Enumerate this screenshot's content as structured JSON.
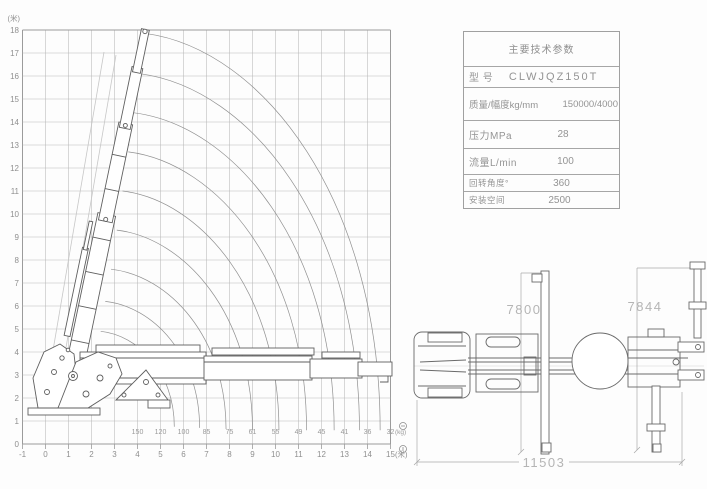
{
  "chart": {
    "y_unit": "(米)",
    "x_unit": "(米)",
    "load_unit": "(kg)",
    "y_ticks": [
      18,
      17,
      16,
      15,
      14,
      13,
      12,
      11,
      10,
      9,
      8,
      7,
      6,
      5,
      4,
      3,
      2,
      1,
      0
    ],
    "x_ticks": [
      -1,
      0,
      1,
      2,
      3,
      4,
      5,
      6,
      7,
      8,
      9,
      10,
      11,
      12,
      13,
      14,
      15
    ]
  },
  "chart_data": {
    "type": "line",
    "title": "起重机工作幅度载荷曲线图 (crane load-radius working range chart)",
    "xlabel": "(米)",
    "ylabel": "(米)",
    "xlim": [
      -1,
      15
    ],
    "ylim": [
      0,
      18
    ],
    "grid": true,
    "load_row": {
      "radius_m": [
        4,
        5,
        6,
        7,
        8,
        9,
        10,
        11,
        12,
        13,
        14,
        15
      ],
      "load_values": [
        150,
        120,
        100,
        85,
        75,
        61,
        55,
        49,
        45,
        41,
        36,
        32
      ],
      "unit": "(kg)"
    },
    "envelope_curves": [
      [
        4.35,
        17.85,
        14.55,
        0.6
      ],
      [
        4.1,
        16.1,
        13.65,
        0.6
      ],
      [
        3.85,
        14.4,
        12.55,
        0.6
      ],
      [
        3.6,
        12.7,
        11.35,
        0.6
      ],
      [
        3.35,
        11.0,
        10.15,
        0.6
      ],
      [
        3.1,
        9.3,
        9.0,
        0.6
      ],
      [
        2.85,
        7.6,
        7.85,
        0.65
      ],
      [
        2.6,
        6.2,
        6.7,
        0.7
      ],
      [
        2.4,
        4.9,
        5.6,
        0.75
      ]
    ]
  },
  "spec_table": {
    "title": "主要技术参数",
    "rows": [
      {
        "label": "型  号",
        "value": "CLWJQZ150T"
      },
      {
        "label": "质量/幅度kg/mm",
        "value": "150000/4000"
      },
      {
        "label": "压力MPa",
        "value": "28"
      },
      {
        "label": "流量L/min",
        "value": "100"
      },
      {
        "label": "回转角度°",
        "value": "360"
      },
      {
        "label": "安装空间",
        "value": "2500"
      }
    ]
  },
  "top_view": {
    "dim_front": "7800",
    "dim_rear": "7844",
    "dim_overall": "11503"
  }
}
